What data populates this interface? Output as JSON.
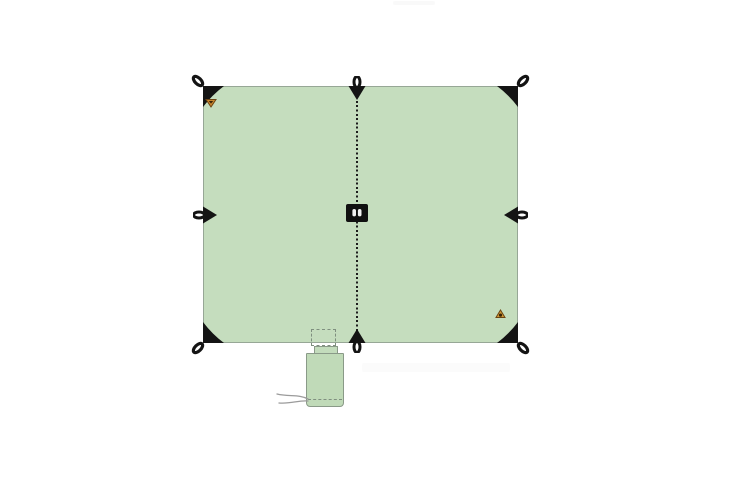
{
  "scene": {
    "kind": "product illustration",
    "subject": "square tarp shown flat from above with its stuff sack",
    "background_color": "#ffffff"
  },
  "colors": {
    "tarp_fill": "#c5ddbe",
    "tarp_outline": "#97a796",
    "sack_fill": "#c0dab8",
    "hardware_black": "#141414",
    "seam_black": "#1c1c1c",
    "logo_orange": "#c8862e",
    "logo_dark": "#3a2408",
    "label_black": "#101010",
    "label_glyph_white": "#f2f2f2",
    "stitch_gray": "#7f8f7f",
    "cord_gray": "#9b9b9b"
  },
  "tarp": {
    "attachment_points_total": 8,
    "corner_loops": [
      "top-left",
      "top-right",
      "bottom-left",
      "bottom-right"
    ],
    "edge_mid_loops": [
      "top-center",
      "left-center",
      "right-center",
      "bottom-center"
    ],
    "center_seam_style": "dotted vertical stitch line",
    "center_label": "black brand patch with white emblem",
    "logo_marks": [
      "orange triangle logo upper-left",
      "orange triangle logo lower-right"
    ]
  },
  "stuff_sack": {
    "placement": "bottom center, hanging below tarp edge",
    "outline": "dashed rectangle on tarp marking sack position",
    "drawcord": "gray cord exiting lower-left of sack"
  }
}
